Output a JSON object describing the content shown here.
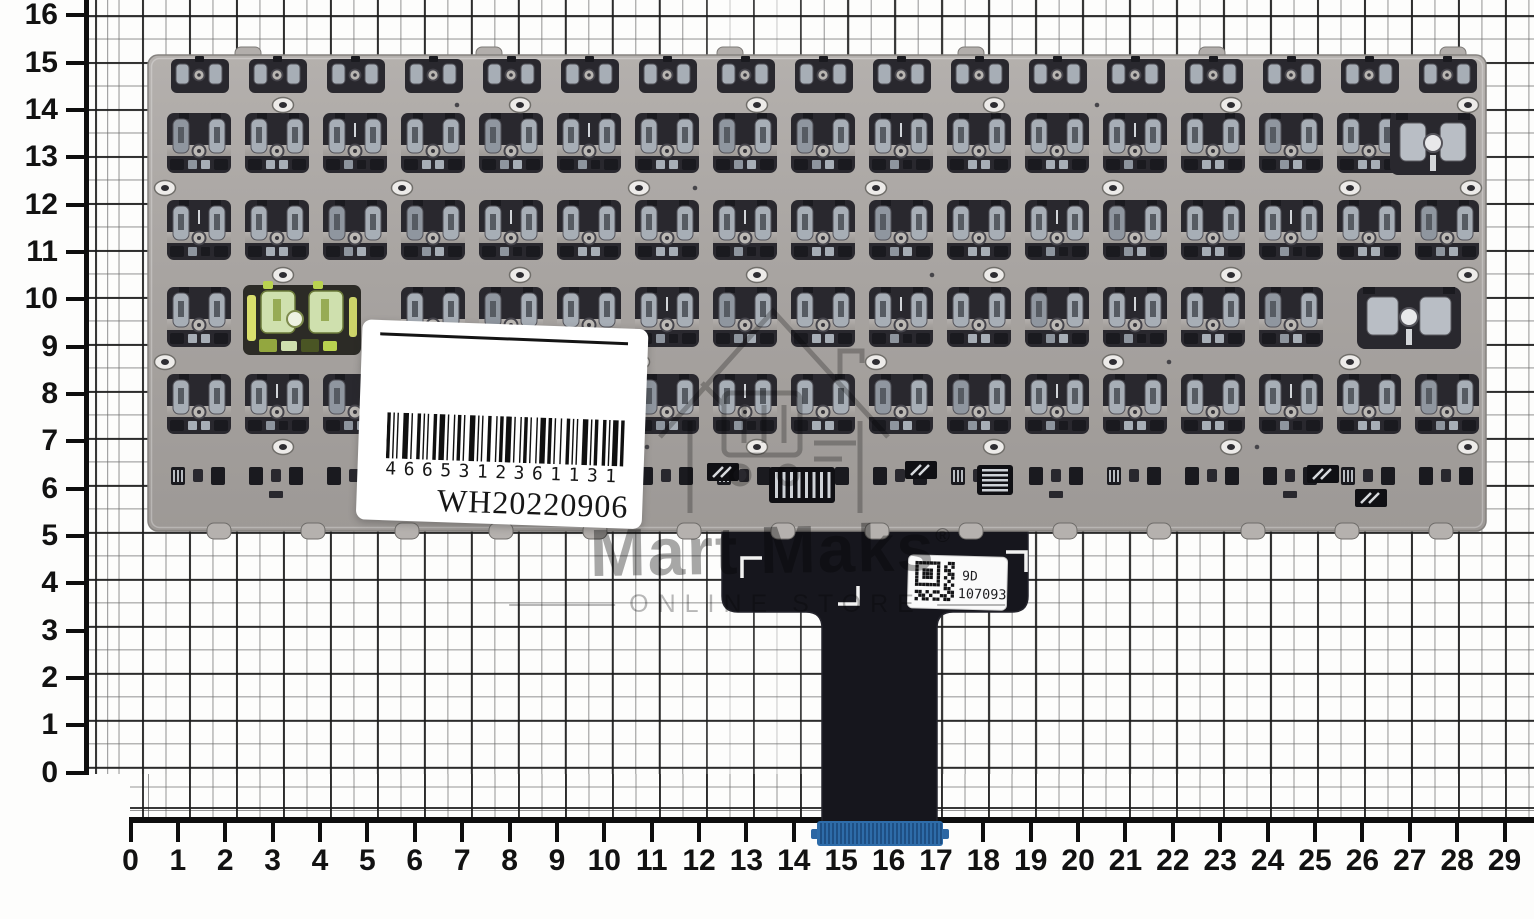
{
  "rulers": {
    "vertical_labels": [
      "0",
      "1",
      "2",
      "3",
      "4",
      "5",
      "6",
      "7",
      "8",
      "9",
      "10",
      "11",
      "12",
      "13",
      "14",
      "15",
      "16"
    ],
    "horizontal_labels": [
      "0",
      "1",
      "2",
      "3",
      "4",
      "5",
      "6",
      "7",
      "8",
      "9",
      "10",
      "11",
      "12",
      "13",
      "14",
      "15",
      "16",
      "17",
      "18",
      "19",
      "20",
      "21",
      "22",
      "23",
      "24",
      "25",
      "26",
      "27",
      "28",
      "29"
    ]
  },
  "sticker": {
    "barcode_digits": "4665312361131",
    "serial": "WH20220906"
  },
  "cable_label": {
    "code_prefix": "9D",
    "code_number": "107093"
  },
  "watermark": {
    "brand": "Mart Maks",
    "registered": "®",
    "tagline": "ONLINE STORE",
    "logo": "house-cart-icon"
  },
  "colors": {
    "plate": "#a7a3a0",
    "plate_light": "#b4b0ad",
    "plate_dark": "#9d9996",
    "cutout": "#29282e",
    "mechanism": "#a7aeb6",
    "cable": "#16161d",
    "connector_blue": "#2e6ca9",
    "connector_blue_dark": "#1e4f84",
    "highlight_green": "#cfe0ae",
    "highlight_yellow": "#d9df6d",
    "grid_major": "#1c1c1c",
    "grid_minor": "#696969",
    "ruler_ink": "#0e0e0e"
  }
}
